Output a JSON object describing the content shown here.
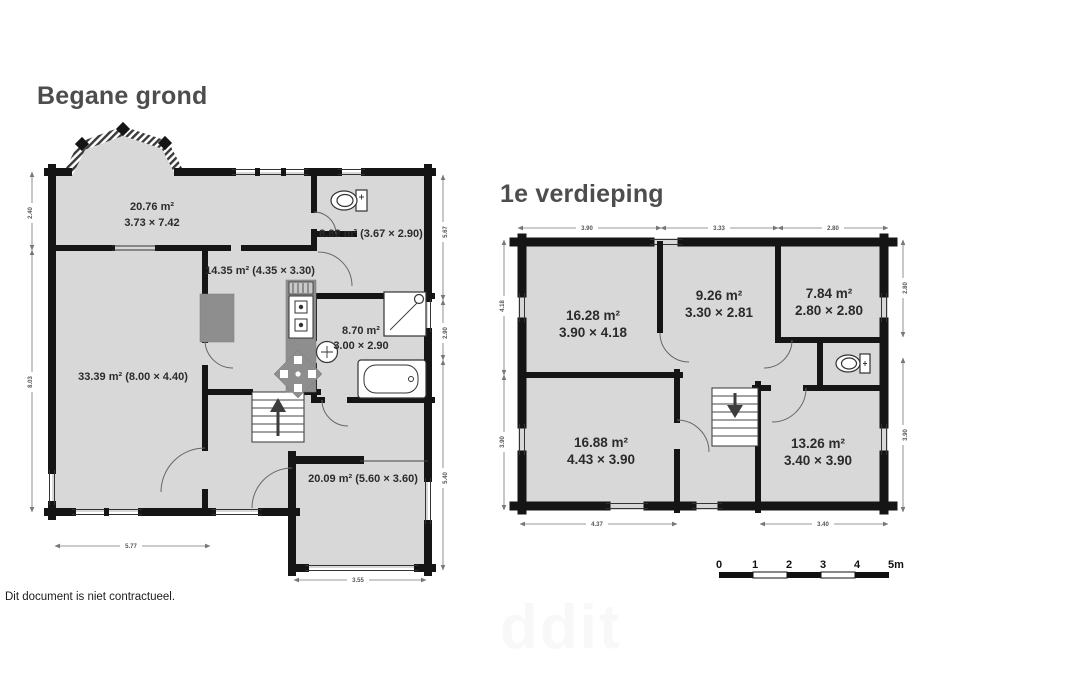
{
  "ground_floor": {
    "title": "Begane grond",
    "rooms": [
      {
        "line1": "20.76 m²",
        "line2": "3.73 × 7.42"
      },
      {
        "line1": "8.82 m² (3.67 × 2.90)",
        "line2": ""
      },
      {
        "line1": "14.35 m² (4.35 × 3.30)",
        "line2": ""
      },
      {
        "line1": "8.70 m²",
        "line2": "3.00 × 2.90"
      },
      {
        "line1": "33.39 m² (8.00 × 4.40)",
        "line2": ""
      },
      {
        "line1": "20.09 m² (5.60 × 3.60)",
        "line2": ""
      }
    ],
    "dims": {
      "left_top": "2.40",
      "left_bottom": "8.03",
      "right_top": "5.67",
      "right_middle": "2.90",
      "right_bottom": "5.40",
      "bottom_left": "5.77",
      "bottom_garage": "3.55"
    }
  },
  "first_floor": {
    "title": "1e verdieping",
    "rooms": [
      {
        "line1": "16.28 m²",
        "line2": "3.90 × 4.18"
      },
      {
        "line1": "9.26 m²",
        "line2": "3.30 × 2.81"
      },
      {
        "line1": "7.84 m²",
        "line2": "2.80 × 2.80"
      },
      {
        "line1": "16.88 m²",
        "line2": "4.43 × 3.90"
      },
      {
        "line1": "13.26 m²",
        "line2": "3.40 × 3.90"
      }
    ],
    "dims": {
      "top_left": "3.90",
      "top_middle": "3.33",
      "top_right": "2.80",
      "left_top": "4.18",
      "left_bottom": "3.90",
      "right_top": "2.80",
      "right_bottom": "3.90",
      "bottom_left": "4.37",
      "bottom_right": "3.40"
    }
  },
  "scale_bar": {
    "labels": [
      "0",
      "1",
      "2",
      "3",
      "4",
      "5m"
    ]
  },
  "footer": "Dit document is niet contractueel.",
  "watermark": "ddit",
  "colors": {
    "wall": "#151515",
    "floor": "#d8d8d8",
    "furniture": "#8e8e8e",
    "title": "#4d4d4d"
  }
}
